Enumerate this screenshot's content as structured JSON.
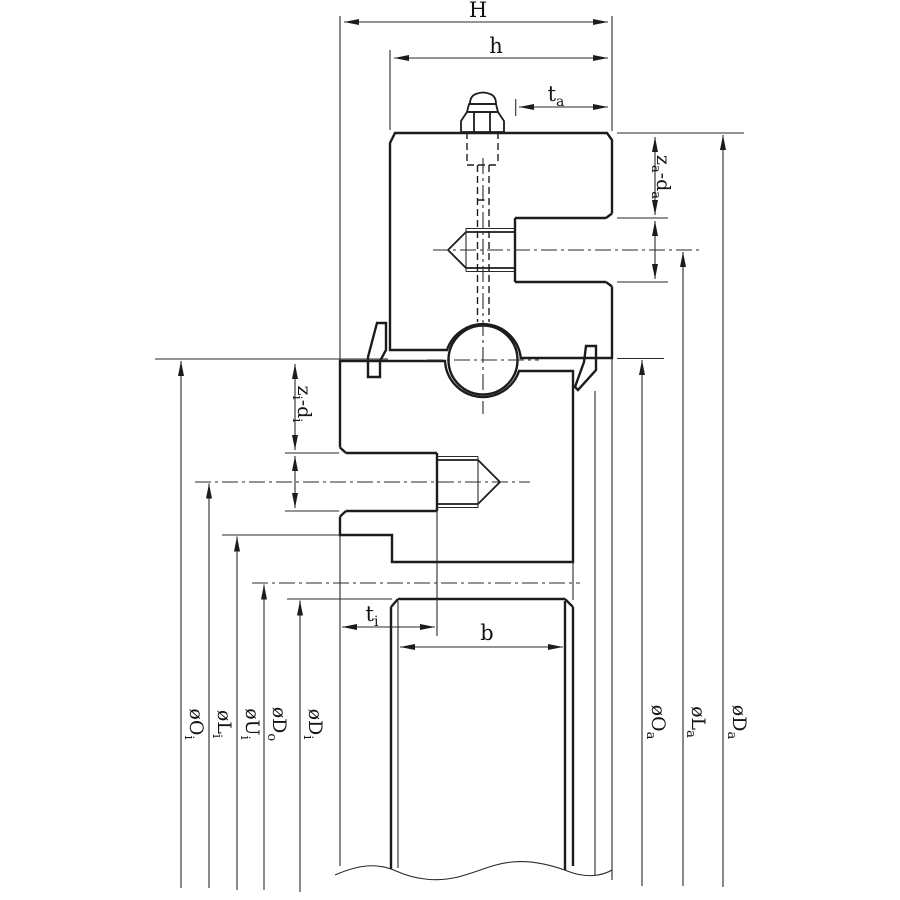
{
  "diagram": {
    "description": "Cross-section engineering drawing of a ball slewing bearing with counterbored and tapped mounting holes, grease fitting and seals",
    "colors": {
      "ring_fill": "#14b9b9",
      "ring_stripe": "#0fb0b0",
      "line": "#1c1c1c",
      "background": "#ffffff"
    },
    "dims": {
      "H": "H",
      "h": "h",
      "t_a": {
        "base": "t",
        "sub": "a"
      },
      "z_a_d_a": {
        "p1": "z",
        "s1": "a",
        "p2": "-d",
        "s2": "a"
      },
      "z_i_d_i": {
        "p1": "z",
        "s1": "i",
        "p2": "-d",
        "s2": "i"
      },
      "t_i": {
        "base": "t",
        "sub": "i"
      },
      "b": "b",
      "O_i": {
        "base": "øO",
        "sub": "i"
      },
      "L_i": {
        "base": "øL",
        "sub": "i"
      },
      "U_i": {
        "base": "øU",
        "sub": "i"
      },
      "D_o": {
        "base": "øD",
        "sub": "o"
      },
      "D_i": {
        "base": "øD",
        "sub": "i"
      },
      "O_a": {
        "base": "øO",
        "sub": "a"
      },
      "L_a": {
        "base": "øL",
        "sub": "a"
      },
      "D_a": {
        "base": "øD",
        "sub": "a"
      }
    }
  }
}
